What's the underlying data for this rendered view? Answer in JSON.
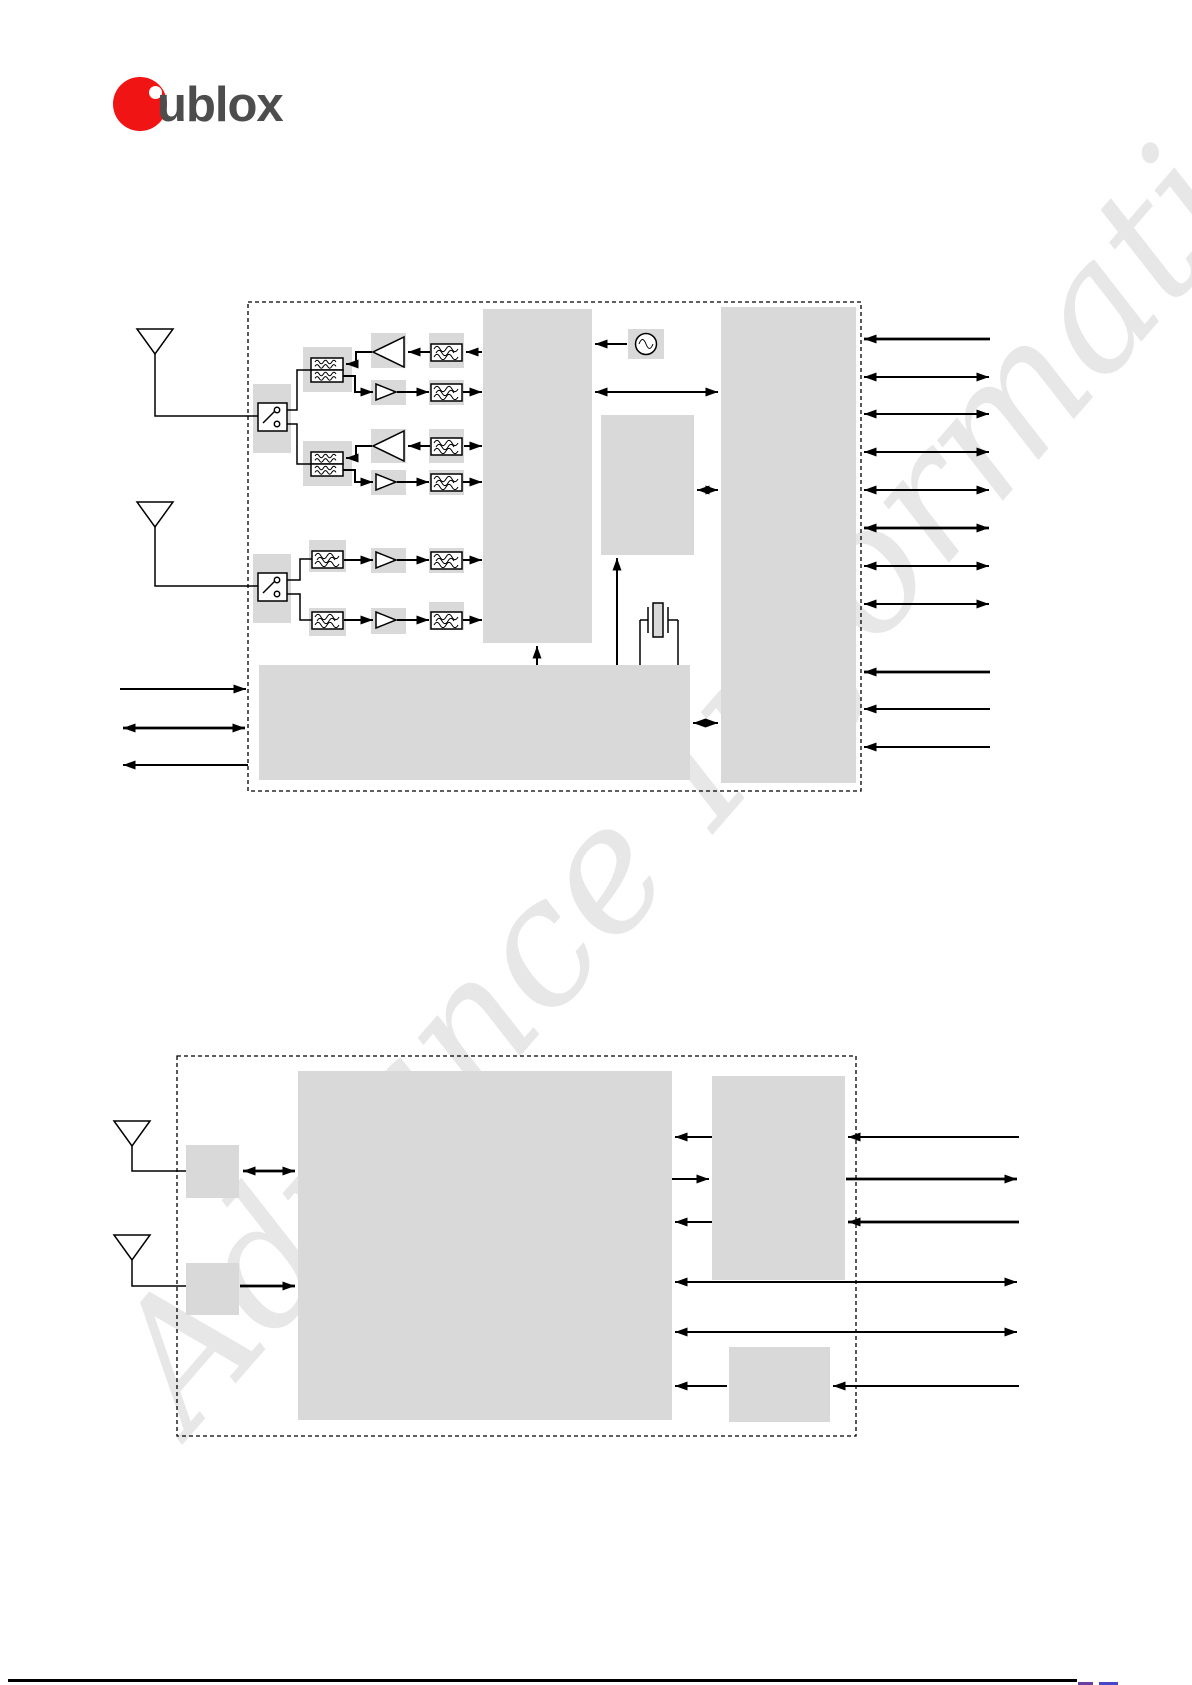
{
  "watermark": {
    "text": "Advance Information"
  },
  "logo": {
    "u": "u",
    "blox": "blox"
  },
  "colors": {
    "brand-red": "#f01414",
    "logo-text": "#4d4d4d",
    "block-gray": "#d9d9d9",
    "line-black": "#000000",
    "watermark-gray": "#e7e7e7",
    "footer-fragment-purple": "#6a3fa0",
    "footer-fragment-blue": "#4646c8"
  },
  "icons": {
    "antenna": "antenna-icon",
    "antenna_switch": "rf-switch-icon",
    "duplexer": "duplexer-filter-icon",
    "power_amplifier": "amplifier-triangle-icon",
    "low_noise_amplifier": "amplifier-triangle-icon",
    "rf_filter": "rf-filter-icon",
    "oscillator": "oscillator-icon",
    "crystal": "crystal-icon",
    "arrow": "signal-arrow-icon"
  },
  "figures": {
    "figure1": {
      "description_visible_text": "",
      "left_arrows": 3,
      "right_arrows": 11
    },
    "figure2": {
      "description_visible_text": "",
      "right_arrows": 8
    }
  }
}
